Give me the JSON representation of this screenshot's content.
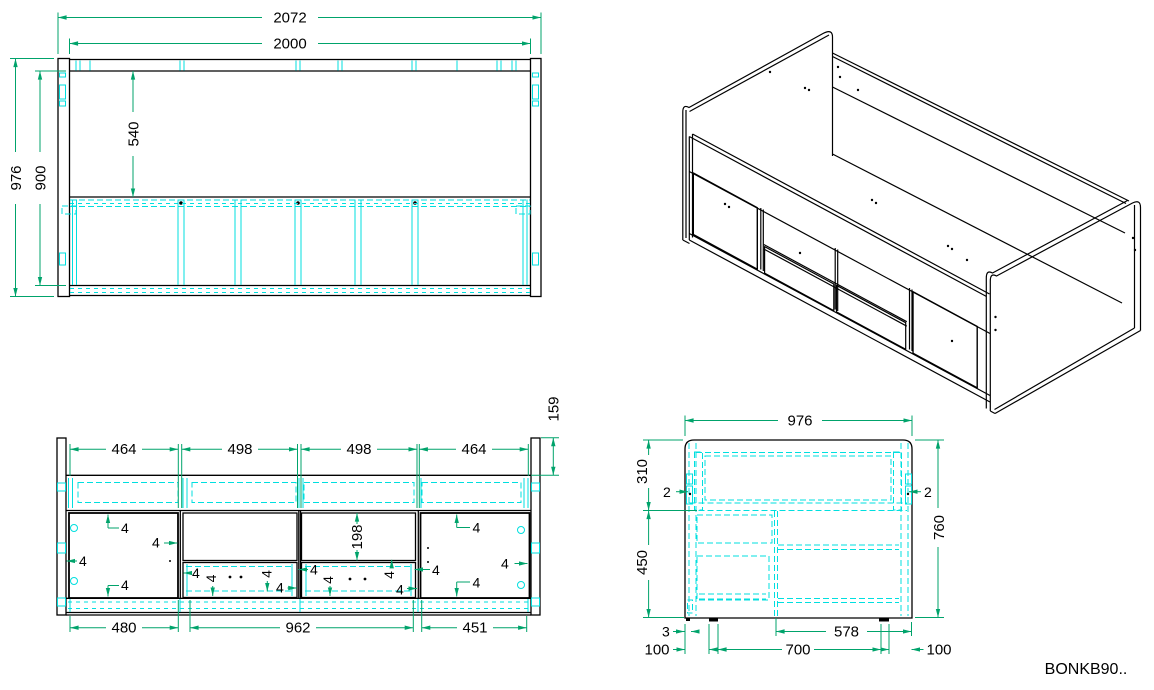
{
  "drawing": {
    "code": "BONKB90..",
    "palette": {
      "outline": "#000000",
      "dimension_line": "#00a36b",
      "hidden_detail": "#00dfdf",
      "text": "#000000",
      "background": "#ffffff"
    },
    "views": {
      "plan": {
        "dims": {
          "overall_length": "2072",
          "inner_length": "2000",
          "overall_width": "976",
          "inner_width": "900",
          "bed_depth": "540"
        }
      },
      "front": {
        "dims": {
          "sections": [
            "464",
            "498",
            "498",
            "464"
          ],
          "top_rail": "159",
          "opening_height": "198",
          "gap": "4",
          "bottom_sections": [
            "480",
            "962",
            "451"
          ]
        }
      },
      "side": {
        "dims": {
          "width": "976",
          "upper_height": "310",
          "lower_height": "450",
          "total_height": "760",
          "edge_gap": "2",
          "foot_offset": "3",
          "inset_left": "100",
          "foot_span": "700",
          "compartment": "578",
          "inset_right": "100"
        }
      }
    }
  }
}
